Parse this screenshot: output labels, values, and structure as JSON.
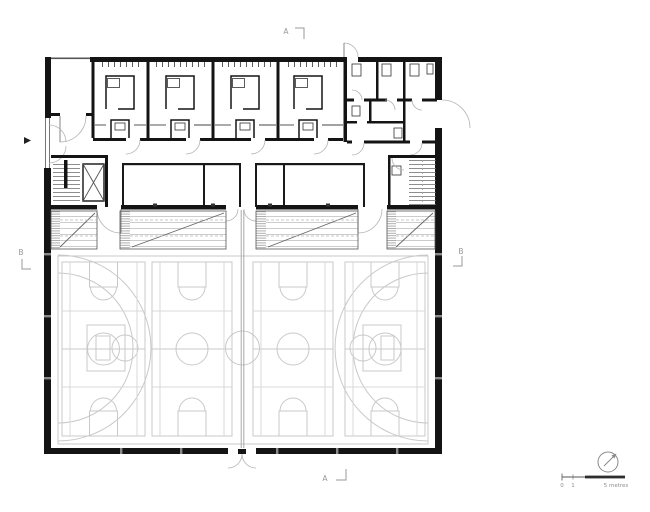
{
  "drawing": {
    "kind": "sports-hall-floor-plan"
  },
  "markers": {
    "section_a_top": "A",
    "section_a_bottom": "A",
    "section_b_left": "B",
    "section_b_right": "B"
  },
  "scale_bar": {
    "zero_label": "0",
    "one_label": "1",
    "end_label": "5 metres"
  },
  "icons": {
    "north": "north-arrow-icon",
    "entrance": "entrance-arrow-icon"
  },
  "colors": {
    "background": "#ffffff",
    "wall": "#141414",
    "thin_line": "#3a3a3a",
    "door_arc": "#b3b3b3",
    "court_line": "#c9c9c9",
    "court_line_light": "#d8d8d8",
    "partition": "#a8a8a8",
    "bleacher_line": "#8a8a8a",
    "annotation": "#9a9a9a",
    "scale_bar": "#2e2e2e"
  }
}
